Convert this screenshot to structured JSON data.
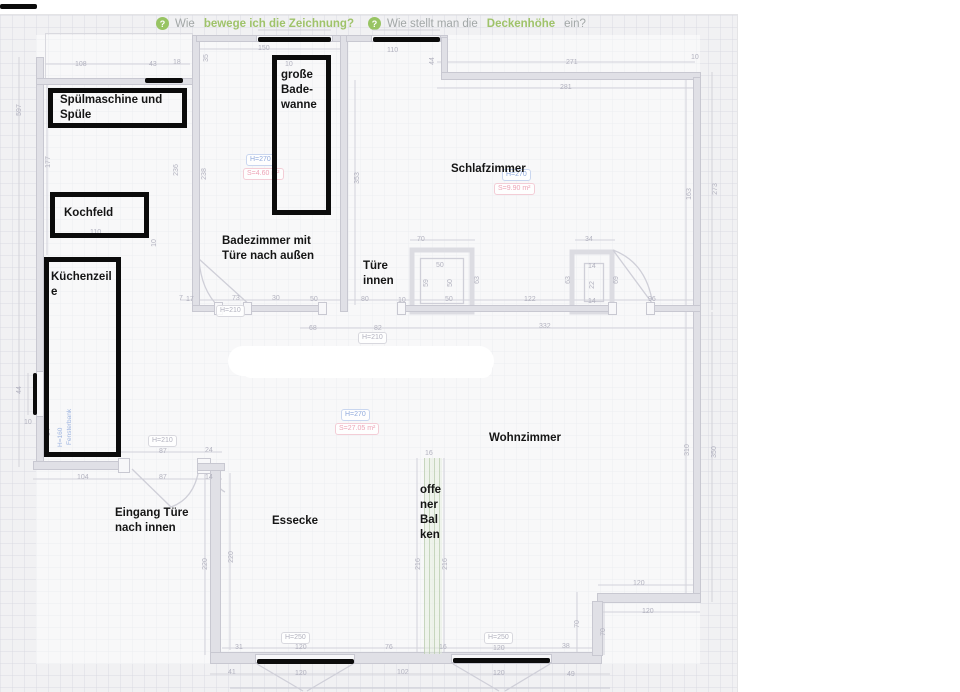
{
  "help": {
    "items": [
      {
        "prefix": "Wie",
        "highlight": "bewege ich die Zeichnung?",
        "suffix": ""
      },
      {
        "prefix": "Wie stellt man die",
        "highlight": "Deckenhöhe",
        "suffix": "ein?"
      }
    ]
  },
  "rooms": {
    "schlafzimmer": {
      "name": "Schlafzimmer",
      "height": "H=270",
      "area": "S=9.90 m²"
    },
    "badezimmer": {
      "height": "H=270",
      "area": "S=4.60 m²"
    },
    "wohnzimmer": {
      "name": "Wohnzimmer",
      "height": "H=270",
      "area": "S=27.05 m²"
    }
  },
  "annotations": {
    "labels": [
      {
        "text": "Spülmaschine und\nSpüle",
        "x": 60,
        "y": 93
      },
      {
        "text": "große\nBade-\nwanne",
        "x": 281,
        "y": 68
      },
      {
        "text": "Kochfeld",
        "x": 64,
        "y": 206
      },
      {
        "text": "Küchenzeil\ne",
        "x": 51,
        "y": 270
      },
      {
        "text": "Badezimmer mit\nTüre nach außen",
        "x": 222,
        "y": 234
      },
      {
        "text": "Türe\ninnen",
        "x": 363,
        "y": 259
      },
      {
        "text": "Schlafzimmer",
        "x": 451,
        "y": 162
      },
      {
        "text": "Wohnzimmer",
        "x": 489,
        "y": 431
      },
      {
        "text": "Essecke",
        "x": 272,
        "y": 514
      },
      {
        "text": "offe\nner\nBal\nken",
        "x": 420,
        "y": 483
      },
      {
        "text": "Eingang Türe\nnach innen",
        "x": 115,
        "y": 506
      }
    ],
    "boxes": [
      {
        "x": 48,
        "y": 88,
        "w": 139,
        "h": 40
      },
      {
        "x": 272,
        "y": 55,
        "w": 59,
        "h": 160
      },
      {
        "x": 50,
        "y": 192,
        "w": 99,
        "h": 46
      },
      {
        "x": 44,
        "y": 257,
        "w": 77,
        "h": 200
      }
    ],
    "bars": [
      {
        "x": 0,
        "y": 4,
        "w": 37,
        "h": 5
      },
      {
        "x": 145,
        "y": 78,
        "w": 38,
        "h": 5
      },
      {
        "x": 258,
        "y": 37,
        "w": 73,
        "h": 5
      },
      {
        "x": 373,
        "y": 37,
        "w": 67,
        "h": 5
      },
      {
        "x": 33,
        "y": 373,
        "w": 4,
        "h": 42
      },
      {
        "x": 257,
        "y": 659,
        "w": 97,
        "h": 5
      },
      {
        "x": 453,
        "y": 658,
        "w": 97,
        "h": 5
      }
    ]
  },
  "plan": {
    "height_labels": [
      {
        "text": "H=270",
        "x": 246,
        "y": 154,
        "kind": "blue"
      },
      {
        "text": "S=4.60 m²",
        "x": 243,
        "y": 168,
        "kind": "pink"
      },
      {
        "text": "H=270",
        "x": 502,
        "y": 169,
        "kind": "blue"
      },
      {
        "text": "S=9.90 m²",
        "x": 494,
        "y": 183,
        "kind": "pink"
      },
      {
        "text": "H=270",
        "x": 341,
        "y": 409,
        "kind": "blue"
      },
      {
        "text": "S=27.05 m²",
        "x": 335,
        "y": 423,
        "kind": "pink"
      },
      {
        "text": "H=210",
        "x": 216,
        "y": 305,
        "kind": "gray"
      },
      {
        "text": "H=210",
        "x": 358,
        "y": 332,
        "kind": "gray"
      },
      {
        "text": "H=210",
        "x": 148,
        "y": 435,
        "kind": "gray"
      },
      {
        "text": "H=250",
        "x": 281,
        "y": 632,
        "kind": "gray"
      },
      {
        "text": "H=250",
        "x": 484,
        "y": 632,
        "kind": "gray"
      }
    ],
    "vertical_notes": [
      {
        "text": "H=160",
        "x": 57,
        "y": 447
      },
      {
        "text": "Fensterbank",
        "x": 66,
        "y": 445
      }
    ],
    "dims": [
      {
        "t": "108",
        "x": 75,
        "y": 61
      },
      {
        "t": "43",
        "x": 149,
        "y": 61
      },
      {
        "t": "18",
        "x": 173,
        "y": 59
      },
      {
        "t": "597",
        "x": 14,
        "y": 106,
        "v": true
      },
      {
        "t": "177",
        "x": 43,
        "y": 158,
        "v": true
      },
      {
        "t": "150",
        "x": 258,
        "y": 45
      },
      {
        "t": "10",
        "x": 285,
        "y": 61
      },
      {
        "t": "35",
        "x": 203,
        "y": 54,
        "v": true
      },
      {
        "t": "110",
        "x": 387,
        "y": 47
      },
      {
        "t": "44",
        "x": 429,
        "y": 57,
        "v": true
      },
      {
        "t": "271",
        "x": 566,
        "y": 59
      },
      {
        "t": "10",
        "x": 691,
        "y": 54
      },
      {
        "t": "281",
        "x": 560,
        "y": 84
      },
      {
        "t": "236",
        "x": 171,
        "y": 166,
        "v": true
      },
      {
        "t": "238",
        "x": 199,
        "y": 170,
        "v": true
      },
      {
        "t": "353",
        "x": 352,
        "y": 174,
        "v": true
      },
      {
        "t": "163",
        "x": 684,
        "y": 190,
        "v": true
      },
      {
        "t": "273",
        "x": 710,
        "y": 185,
        "v": true
      },
      {
        "t": "70",
        "x": 417,
        "y": 236
      },
      {
        "t": "34",
        "x": 585,
        "y": 236
      },
      {
        "t": "50",
        "x": 436,
        "y": 262
      },
      {
        "t": "59",
        "x": 423,
        "y": 279,
        "v": true
      },
      {
        "t": "50",
        "x": 447,
        "y": 279,
        "v": true
      },
      {
        "t": "63",
        "x": 474,
        "y": 276,
        "v": true
      },
      {
        "t": "14",
        "x": 588,
        "y": 263
      },
      {
        "t": "22",
        "x": 589,
        "y": 281,
        "v": true
      },
      {
        "t": "14",
        "x": 588,
        "y": 298
      },
      {
        "t": "63",
        "x": 565,
        "y": 276,
        "v": true
      },
      {
        "t": "69",
        "x": 613,
        "y": 276,
        "v": true
      },
      {
        "t": "7",
        "x": 179,
        "y": 295
      },
      {
        "t": "17",
        "x": 186,
        "y": 296
      },
      {
        "t": "73",
        "x": 232,
        "y": 295
      },
      {
        "t": "30",
        "x": 272,
        "y": 295
      },
      {
        "t": "50",
        "x": 310,
        "y": 296
      },
      {
        "t": "80",
        "x": 361,
        "y": 296
      },
      {
        "t": "10",
        "x": 398,
        "y": 297
      },
      {
        "t": "50",
        "x": 445,
        "y": 296
      },
      {
        "t": "122",
        "x": 524,
        "y": 296
      },
      {
        "t": "96",
        "x": 648,
        "y": 296
      },
      {
        "t": "68",
        "x": 309,
        "y": 325
      },
      {
        "t": "82",
        "x": 374,
        "y": 325
      },
      {
        "t": "332",
        "x": 539,
        "y": 323
      },
      {
        "t": "110",
        "x": 90,
        "y": 229
      },
      {
        "t": "10",
        "x": 151,
        "y": 239,
        "v": true
      },
      {
        "t": "44",
        "x": 16,
        "y": 386,
        "v": true
      },
      {
        "t": "94",
        "x": 45,
        "y": 428,
        "v": true
      },
      {
        "t": "10",
        "x": 24,
        "y": 419
      },
      {
        "t": "87",
        "x": 159,
        "y": 448
      },
      {
        "t": "24",
        "x": 205,
        "y": 447
      },
      {
        "t": "104",
        "x": 77,
        "y": 474
      },
      {
        "t": "87",
        "x": 159,
        "y": 474
      },
      {
        "t": "14",
        "x": 205,
        "y": 474
      },
      {
        "t": "220",
        "x": 200,
        "y": 560,
        "v": true
      },
      {
        "t": "220",
        "x": 226,
        "y": 553,
        "v": true
      },
      {
        "t": "16",
        "x": 425,
        "y": 450
      },
      {
        "t": "216",
        "x": 413,
        "y": 560,
        "v": true
      },
      {
        "t": "216",
        "x": 440,
        "y": 560,
        "v": true
      },
      {
        "t": "31",
        "x": 235,
        "y": 644
      },
      {
        "t": "120",
        "x": 295,
        "y": 644
      },
      {
        "t": "76",
        "x": 385,
        "y": 644
      },
      {
        "t": "16",
        "x": 439,
        "y": 644
      },
      {
        "t": "120",
        "x": 493,
        "y": 645
      },
      {
        "t": "38",
        "x": 562,
        "y": 643
      },
      {
        "t": "41",
        "x": 228,
        "y": 669
      },
      {
        "t": "120",
        "x": 295,
        "y": 670
      },
      {
        "t": "102",
        "x": 397,
        "y": 669
      },
      {
        "t": "120",
        "x": 493,
        "y": 670
      },
      {
        "t": "49",
        "x": 567,
        "y": 671
      },
      {
        "t": "120",
        "x": 633,
        "y": 580
      },
      {
        "t": "120",
        "x": 642,
        "y": 608
      },
      {
        "t": "70",
        "x": 574,
        "y": 620,
        "v": true
      },
      {
        "t": "70",
        "x": 600,
        "y": 628,
        "v": true
      },
      {
        "t": "310",
        "x": 682,
        "y": 446,
        "v": true
      },
      {
        "t": "350",
        "x": 709,
        "y": 448,
        "v": true
      }
    ]
  },
  "colors": {
    "canvas_bg": "#f1f1f3",
    "wall": "#e0e0e6",
    "annotation": "#0b0b0b",
    "dim_text": "#b2b2bf",
    "height_blue": "#8fa9dc",
    "area_pink": "#eda4b6",
    "help_green": "#9fc36a",
    "beam_green": "#bed0b4"
  }
}
